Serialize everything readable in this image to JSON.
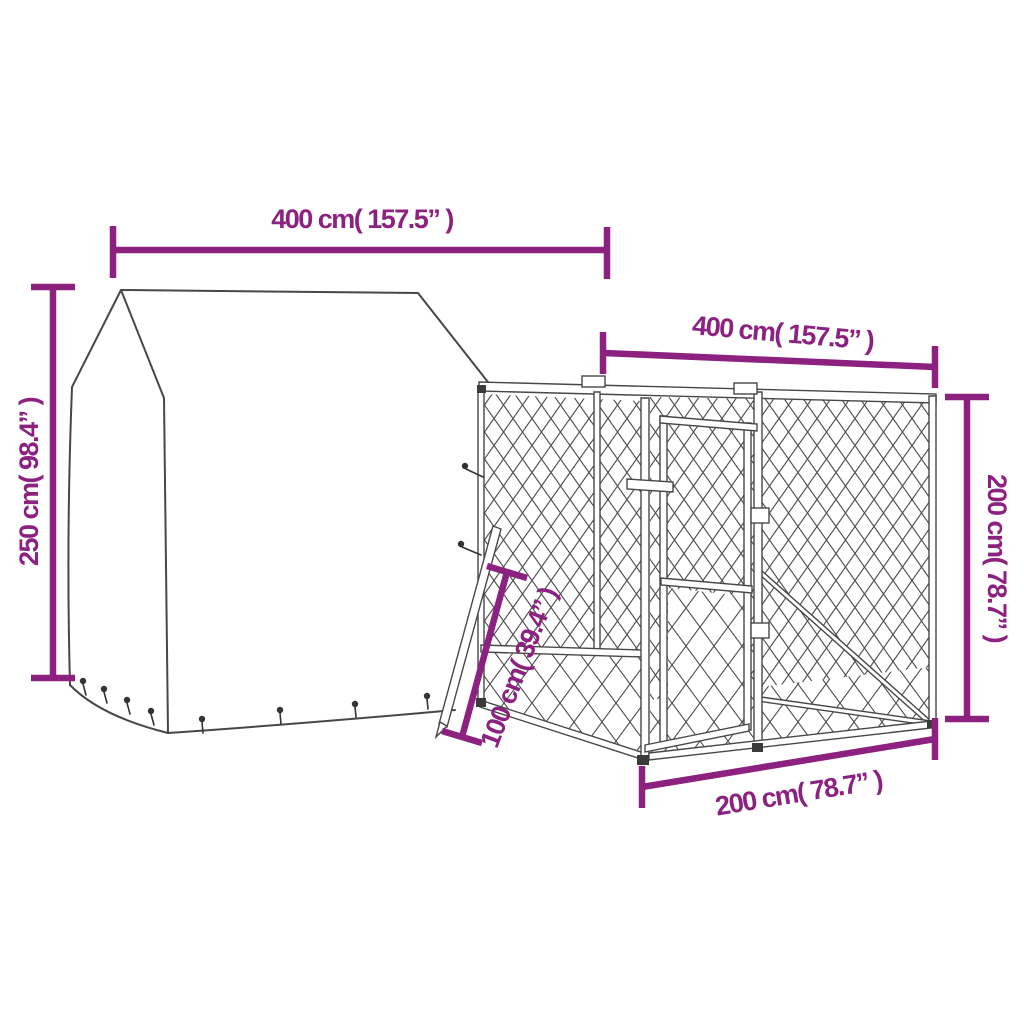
{
  "diagram": {
    "background_color": "#ffffff",
    "line_art_color": "#474747",
    "dimension_color": "#8c2180",
    "labels": {
      "cover_width": "400 cm( 157.5” )",
      "cage_width": "400 cm( 157.5” )",
      "cover_height": "250 cm( 98.4” )",
      "cage_height": "200 cm( 78.7” )",
      "cage_depth": "200 cm( 78.7” )",
      "lower_section_height": "100 cm( 39.4” )"
    }
  }
}
